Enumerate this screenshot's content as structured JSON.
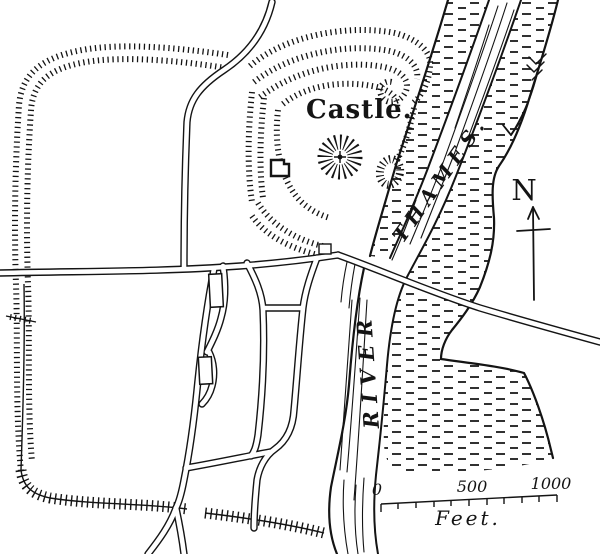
{
  "map": {
    "castle_label": "Castle.",
    "river": {
      "word_lower": "RIVER",
      "word_upper": "THAMES."
    },
    "compass": {
      "north": "N",
      "icon": "north-arrow-icon"
    },
    "flow": {
      "icon": "river-flow-arrow-icon"
    },
    "scale": {
      "zero": "0",
      "mid": "500",
      "max": "1000",
      "unit": "Feet."
    },
    "colors": {
      "ink": "#141414",
      "paper": "#ffffff"
    }
  }
}
